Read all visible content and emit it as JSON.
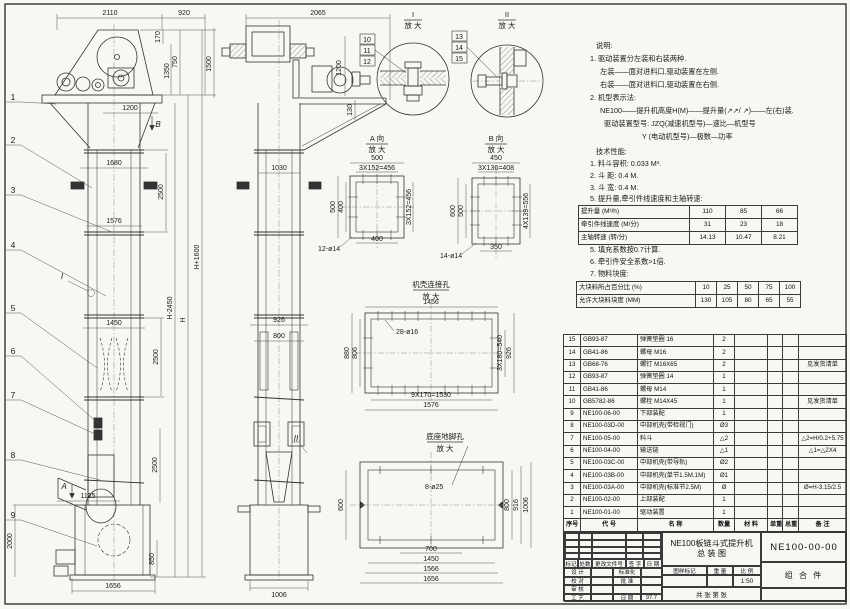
{
  "sheet_meta": {
    "title_line1": "NE100板链斗式提升机",
    "title_line2": "总  装  图",
    "drawing_no": "NE100-00-00",
    "part_class": "组 合 件",
    "scale_label": "1:50",
    "sheet_note": "共  张  第  张",
    "rev_headers": [
      "标记",
      "处数",
      "更改文件号",
      "签 字",
      "日 期"
    ],
    "sign_rows": [
      [
        "设 计",
        "",
        "标准化",
        ""
      ],
      [
        "校 对",
        "",
        "批 准",
        ""
      ],
      [
        "审 核",
        "",
        "",
        ""
      ],
      [
        "工 艺",
        "",
        "日 期",
        "97.7"
      ]
    ],
    "scale_headers": [
      "图样标记",
      "重 量",
      "比 例"
    ]
  },
  "bom": {
    "headers": [
      "序号",
      "代    号",
      "名      称",
      "数量",
      "材 料",
      "单重",
      "总重",
      "备  注"
    ],
    "rows": [
      [
        "15",
        "GB93-87",
        "弹簧垫圈 16",
        "2",
        "",
        "",
        "",
        ""
      ],
      [
        "14",
        "GB41-86",
        "螺母 M16",
        "2",
        "",
        "",
        "",
        ""
      ],
      [
        "13",
        "GB68-76",
        "螺钉 M16X65",
        "2",
        "",
        "",
        "",
        "见发货清单"
      ],
      [
        "12",
        "GB93-87",
        "弹簧垫圈 14",
        "1",
        "",
        "",
        "",
        ""
      ],
      [
        "11",
        "GB41-86",
        "螺母 M14",
        "1",
        "",
        "",
        "",
        ""
      ],
      [
        "10",
        "GB5782-86",
        "螺栓 M14X45",
        "1",
        "",
        "",
        "",
        "见发货清单"
      ],
      [
        "9",
        "NE100-06-00",
        "下部装配",
        "1",
        "",
        "",
        "",
        ""
      ],
      [
        "8",
        "NE100-03D-00",
        "中部机壳(带检视门)",
        "Ø3",
        "",
        "",
        "",
        ""
      ],
      [
        "7",
        "NE100-05-00",
        "料斗",
        "△2",
        "",
        "",
        "",
        "△2=H/0.2+5.75"
      ],
      [
        "6",
        "NE100-04-00",
        "输送链",
        "△1",
        "",
        "",
        "",
        "△1=△2X4"
      ],
      [
        "5",
        "NE100-03C-00",
        "中部机壳(带导轨)",
        "Ø2",
        "",
        "",
        "",
        ""
      ],
      [
        "4",
        "NE100-03B-00",
        "中部机壳(单节1.5M,1M)",
        "Ø1",
        "",
        "",
        "",
        ""
      ],
      [
        "3",
        "NE100-03A-00",
        "中部机壳(标准节2.5M)",
        "Ø",
        "",
        "",
        "",
        "Ø=H-3.15/2.5"
      ],
      [
        "2",
        "NE100-02-00",
        "上部装配",
        "1",
        "",
        "",
        "",
        ""
      ],
      [
        "1",
        "NE100-01-00",
        "驱动装置",
        "1",
        "",
        "",
        "",
        ""
      ]
    ]
  },
  "tech_table1": {
    "rows": [
      [
        "提升量 (M³/h)",
        "110",
        "85",
        "66"
      ],
      [
        "牵引件线速度 (M/分)",
        "31",
        "23",
        "18"
      ],
      [
        "主轴转速 (转/分)",
        "14.13",
        "10.47",
        "8.21"
      ]
    ]
  },
  "tech_table2": {
    "rows": [
      [
        "大块料所占百分比 (%)",
        "10",
        "25",
        "50",
        "75",
        "100"
      ],
      [
        "允许大块料块度 (MM)",
        "130",
        "105",
        "80",
        "65",
        "55"
      ]
    ]
  },
  "annotations": [
    {
      "x": 596,
      "y": 48,
      "t": "说明:",
      "k": "note",
      "a": "s"
    },
    {
      "x": 590,
      "y": 61,
      "t": "1. 驱动装置分左装和右装两种.",
      "k": "note",
      "a": "s"
    },
    {
      "x": 600,
      "y": 74,
      "t": "左装——面对进料口,驱动装置在左侧.",
      "k": "note",
      "a": "s"
    },
    {
      "x": 600,
      "y": 87,
      "t": "右装——面对进料口,驱动装置在右侧.",
      "k": "note",
      "a": "s"
    },
    {
      "x": 590,
      "y": 100,
      "t": "2. 机型表示法:",
      "k": "note",
      "a": "s"
    },
    {
      "x": 600,
      "y": 113,
      "t": "NE100——提升机高度H(M)——提升量(↗↗/ ↗)——左(右)装.",
      "k": "note",
      "a": "s"
    },
    {
      "x": 604,
      "y": 126,
      "t": "驱动装置型号: JZQ(减速机型号)—速比—机型号",
      "k": "note",
      "a": "s"
    },
    {
      "x": 642,
      "y": 139,
      "t": "Y (电动机型号)—极数—功率",
      "k": "note",
      "a": "s"
    },
    {
      "x": 596,
      "y": 154,
      "t": "技术性能:",
      "k": "note",
      "a": "s"
    },
    {
      "x": 590,
      "y": 166,
      "t": "1. 料斗容积: 0.033 M³.",
      "k": "note",
      "a": "s"
    },
    {
      "x": 590,
      "y": 178,
      "t": "2. 斗  距: 0.4 M.",
      "k": "note",
      "a": "s"
    },
    {
      "x": 590,
      "y": 190,
      "t": "3. 斗  宽: 0.4 M.",
      "k": "note",
      "a": "s"
    },
    {
      "x": 590,
      "y": 201,
      "t": "5. 提升量,牵引件线速度和主轴转速:",
      "k": "note",
      "a": "s"
    },
    {
      "x": 590,
      "y": 252,
      "t": "5. 填充系数按0.7计算.",
      "k": "note",
      "a": "s"
    },
    {
      "x": 590,
      "y": 264,
      "t": "6. 牵引件安全系数>1倍.",
      "k": "note",
      "a": "s"
    },
    {
      "x": 590,
      "y": 276,
      "t": "7. 物料块度:",
      "k": "note",
      "a": "s"
    },
    {
      "x": 110,
      "y": 15,
      "t": "2110"
    },
    {
      "x": 184,
      "y": 15,
      "t": "920"
    },
    {
      "x": 160,
      "y": 37,
      "t": "170",
      "r": 1
    },
    {
      "x": 177,
      "y": 62,
      "t": "750",
      "r": 1
    },
    {
      "x": 169,
      "y": 71,
      "t": "1350",
      "r": 1
    },
    {
      "x": 211,
      "y": 64,
      "t": "1500",
      "r": 1
    },
    {
      "x": 130,
      "y": 110,
      "t": "1200"
    },
    {
      "x": 114,
      "y": 165,
      "t": "1680"
    },
    {
      "x": 114,
      "y": 223,
      "t": "1576"
    },
    {
      "x": 114,
      "y": 325,
      "t": "1450"
    },
    {
      "x": 88,
      "y": 498,
      "t": "1125"
    },
    {
      "x": 12,
      "y": 541,
      "t": "2000",
      "r": 1
    },
    {
      "x": 154,
      "y": 559,
      "t": "850",
      "r": 1
    },
    {
      "x": 113,
      "y": 588,
      "t": "1656"
    },
    {
      "x": 163,
      "y": 192,
      "t": "2500",
      "r": 1
    },
    {
      "x": 158,
      "y": 357,
      "t": "2500",
      "r": 1
    },
    {
      "x": 157,
      "y": 465,
      "t": "2500",
      "r": 1
    },
    {
      "x": 172,
      "y": 308,
      "t": "H-2450",
      "r": 1
    },
    {
      "x": 185,
      "y": 320,
      "t": "H",
      "r": 1
    },
    {
      "x": 199,
      "y": 257,
      "t": "H+1600",
      "r": 1
    },
    {
      "x": 13,
      "y": 100,
      "t": "1",
      "k": "balloon"
    },
    {
      "x": 13,
      "y": 143,
      "t": "2",
      "k": "balloon"
    },
    {
      "x": 13,
      "y": 193,
      "t": "3",
      "k": "balloon"
    },
    {
      "x": 13,
      "y": 248,
      "t": "4",
      "k": "balloon"
    },
    {
      "x": 13,
      "y": 311,
      "t": "5",
      "k": "balloon"
    },
    {
      "x": 13,
      "y": 354,
      "t": "6",
      "k": "balloon"
    },
    {
      "x": 13,
      "y": 398,
      "t": "7",
      "k": "balloon"
    },
    {
      "x": 13,
      "y": 458,
      "t": "8",
      "k": "balloon"
    },
    {
      "x": 13,
      "y": 518,
      "t": "9",
      "k": "balloon"
    },
    {
      "x": 62,
      "y": 279,
      "t": "I",
      "k": "mark"
    },
    {
      "x": 158,
      "y": 127,
      "t": "B",
      "k": "mark"
    },
    {
      "x": 64,
      "y": 489,
      "t": "A",
      "k": "mark"
    },
    {
      "x": 296,
      "y": 441,
      "t": "II",
      "k": "mark"
    },
    {
      "x": 318,
      "y": 15,
      "t": "2065"
    },
    {
      "x": 341,
      "y": 68,
      "t": "1200",
      "r": 1
    },
    {
      "x": 352,
      "y": 110,
      "t": "130",
      "r": 1
    },
    {
      "x": 279,
      "y": 170,
      "t": "1030"
    },
    {
      "x": 279,
      "y": 322,
      "t": "926"
    },
    {
      "x": 279,
      "y": 338,
      "t": "800"
    },
    {
      "x": 279,
      "y": 597,
      "t": "1006"
    },
    {
      "x": 413,
      "y": 17,
      "t": "I",
      "k": "title"
    },
    {
      "x": 413,
      "y": 28,
      "t": "放 大",
      "k": "title"
    },
    {
      "x": 507,
      "y": 17,
      "t": "II",
      "k": "title"
    },
    {
      "x": 507,
      "y": 28,
      "t": "放 大",
      "k": "title"
    },
    {
      "x": 367,
      "y": 42,
      "t": "10",
      "k": "box"
    },
    {
      "x": 367,
      "y": 53,
      "t": "11",
      "k": "box"
    },
    {
      "x": 367,
      "y": 64,
      "t": "12",
      "k": "box"
    },
    {
      "x": 459,
      "y": 39,
      "t": "13",
      "k": "box"
    },
    {
      "x": 459,
      "y": 50,
      "t": "14",
      "k": "box"
    },
    {
      "x": 459,
      "y": 61,
      "t": "15",
      "k": "box"
    },
    {
      "x": 377,
      "y": 141,
      "t": "A 向",
      "k": "title"
    },
    {
      "x": 377,
      "y": 152,
      "t": "放 大",
      "k": "title"
    },
    {
      "x": 496,
      "y": 141,
      "t": "B 向",
      "k": "title"
    },
    {
      "x": 496,
      "y": 152,
      "t": "放 大",
      "k": "title"
    },
    {
      "x": 377,
      "y": 160,
      "t": "500"
    },
    {
      "x": 377,
      "y": 170,
      "t": "3X152=456"
    },
    {
      "x": 335,
      "y": 207,
      "t": "500",
      "r": 1
    },
    {
      "x": 343,
      "y": 207,
      "t": "400",
      "r": 1
    },
    {
      "x": 411,
      "y": 207,
      "t": "3X152=456",
      "r": 1
    },
    {
      "x": 377,
      "y": 241,
      "t": "400"
    },
    {
      "x": 318,
      "y": 251,
      "t": "12-ø14",
      "a": "s"
    },
    {
      "x": 496,
      "y": 160,
      "t": "450"
    },
    {
      "x": 496,
      "y": 170,
      "t": "3X136=408"
    },
    {
      "x": 455,
      "y": 211,
      "t": "600",
      "r": 1
    },
    {
      "x": 463,
      "y": 211,
      "t": "500",
      "r": 1
    },
    {
      "x": 528,
      "y": 211,
      "t": "4X139=556",
      "r": 1
    },
    {
      "x": 496,
      "y": 249,
      "t": "350"
    },
    {
      "x": 440,
      "y": 258,
      "t": "14-ø14",
      "a": "s"
    },
    {
      "x": 431,
      "y": 287,
      "t": "机壳连接孔",
      "k": "title"
    },
    {
      "x": 431,
      "y": 299,
      "t": "放 大",
      "k": "title"
    },
    {
      "x": 431,
      "y": 304,
      "t": "1456"
    },
    {
      "x": 349,
      "y": 353,
      "t": "880",
      "r": 1
    },
    {
      "x": 357,
      "y": 353,
      "t": "806",
      "r": 1
    },
    {
      "x": 502,
      "y": 353,
      "t": "3X180=540",
      "r": 1
    },
    {
      "x": 511,
      "y": 353,
      "t": "926",
      "r": 1
    },
    {
      "x": 431,
      "y": 397,
      "t": "9X170=1530"
    },
    {
      "x": 431,
      "y": 407,
      "t": "1576"
    },
    {
      "x": 396,
      "y": 334,
      "t": "28-ø16",
      "a": "s"
    },
    {
      "x": 445,
      "y": 439,
      "t": "底座地脚孔",
      "k": "title"
    },
    {
      "x": 445,
      "y": 451,
      "t": "放 大",
      "k": "title"
    },
    {
      "x": 425,
      "y": 489,
      "t": "8-ø25",
      "a": "s"
    },
    {
      "x": 343,
      "y": 505,
      "t": "600",
      "r": 1
    },
    {
      "x": 509,
      "y": 505,
      "t": "800",
      "r": 1
    },
    {
      "x": 518,
      "y": 505,
      "t": "916",
      "r": 1
    },
    {
      "x": 528,
      "y": 505,
      "t": "1006",
      "r": 1
    },
    {
      "x": 431,
      "y": 551,
      "t": "700"
    },
    {
      "x": 431,
      "y": 561,
      "t": "1450"
    },
    {
      "x": 431,
      "y": 571,
      "t": "1566"
    },
    {
      "x": 431,
      "y": 581,
      "t": "1656"
    }
  ]
}
